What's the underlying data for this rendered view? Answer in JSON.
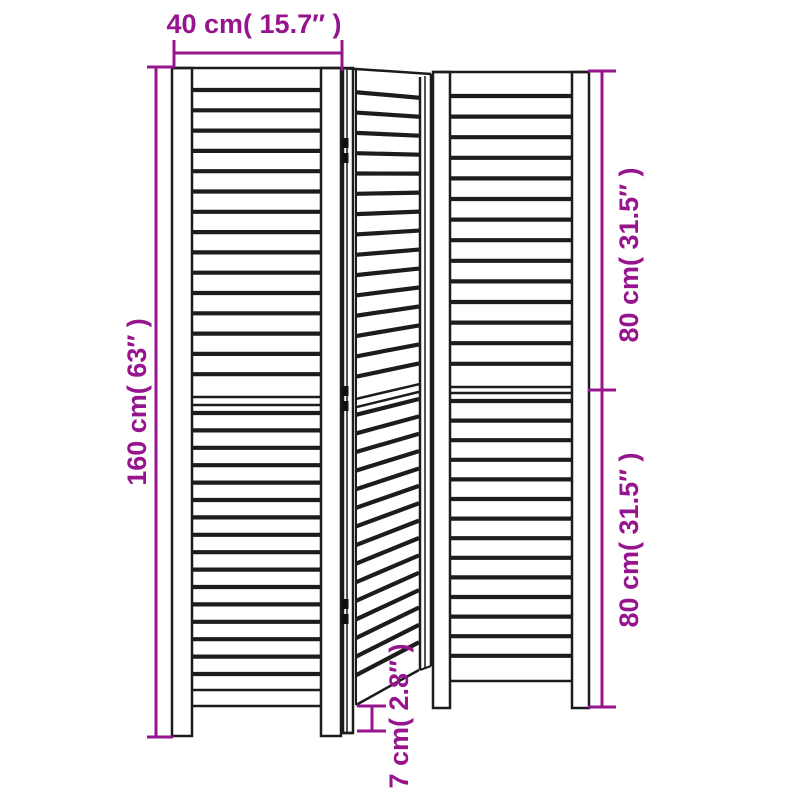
{
  "page": {
    "kind": "product-dimension-diagram",
    "subject": "3-panel louvered folding room divider"
  },
  "colors": {
    "dimension": "#96148E",
    "outline": "#1c1c1c",
    "hinge": "#111111",
    "background": "#ffffff"
  },
  "dimensions": {
    "width": {
      "label": "40 cm( 15.7″ )",
      "value_cm": 40,
      "value_in": 15.7
    },
    "height": {
      "label": "160 cm( 63″ )",
      "value_cm": 160,
      "value_in": 63
    },
    "upper_section": {
      "label": "80 cm( 31.5″ )",
      "value_cm": 80,
      "value_in": 31.5
    },
    "lower_section": {
      "label": "80 cm( 31.5″ )",
      "value_cm": 80,
      "value_in": 31.5
    },
    "foot": {
      "label": "7 cm( 2.8″ )",
      "value_cm": 7,
      "value_in": 2.8
    }
  }
}
